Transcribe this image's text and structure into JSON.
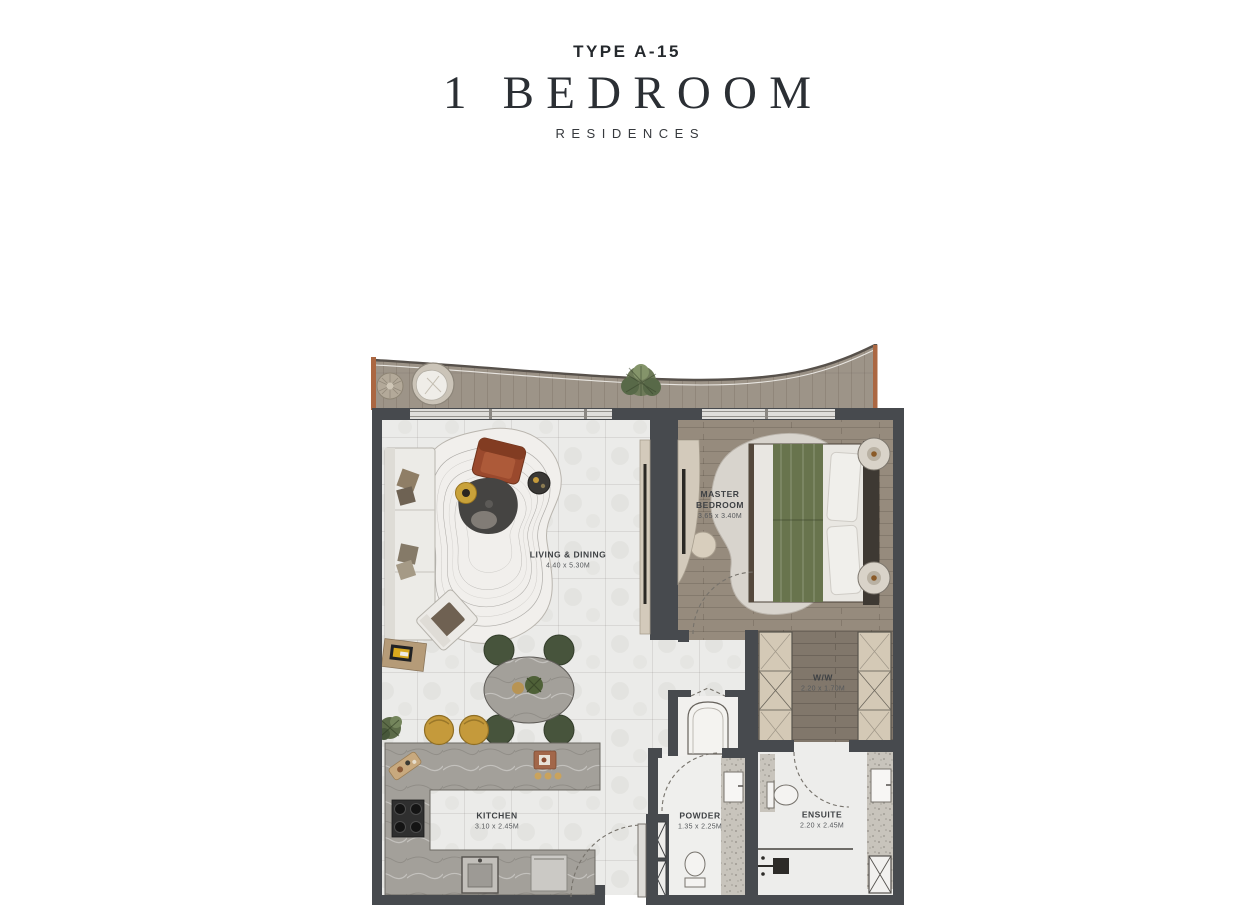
{
  "header": {
    "type_label": "TYPE A-15",
    "title": "1 BEDROOM",
    "subtitle": "RESIDENCES"
  },
  "floorplan": {
    "rooms": [
      {
        "id": "living_dining",
        "name": "LIVING & DINING",
        "dims": "4.40 x 5.30M"
      },
      {
        "id": "master_bedroom",
        "name": "MASTER BEDROOM",
        "dims": "3.65 x 3.40M"
      },
      {
        "id": "walk_in_wardrobe",
        "name": "W/W",
        "dims": "2.20 x 1.70M"
      },
      {
        "id": "kitchen",
        "name": "KITCHEN",
        "dims": "3.10 x 2.45M"
      },
      {
        "id": "powder",
        "name": "POWDER",
        "dims": "1.35 x 2.25M"
      },
      {
        "id": "ensuite",
        "name": "ENSUITE",
        "dims": "2.20 x 2.45M"
      }
    ],
    "colors": {
      "wall": "#474a4e",
      "balcony_wood": "#9d9488",
      "bedroom_wood": "#968b7d",
      "marble_floor": "#ebebe9",
      "speckle_tile": "#c8c4bc",
      "accent_rust": "#9a492d",
      "accent_gold": "#c59a3b",
      "accent_green": "#68744d",
      "trim_orange": "#ab6742"
    }
  }
}
